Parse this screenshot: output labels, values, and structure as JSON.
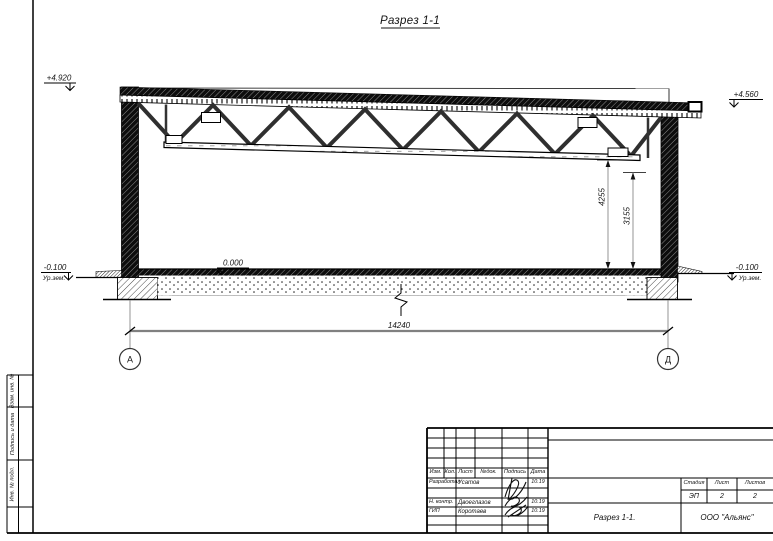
{
  "ink_color": "#141414",
  "dim_line_color": "#808080",
  "drawing": {
    "section_title": "Разрез 1-1",
    "elevation_marks": {
      "roof_left": "+4.920",
      "roof_right": "+4.560",
      "floor": "0.000",
      "ground_left": "-0.100",
      "ground_left_label": "Ур.зем.",
      "ground_right": "-0.100",
      "ground_right_label": "Ур.зем."
    },
    "dimensions": {
      "overall_span": "14240",
      "truss_bottom_height": "4255",
      "clear_height": "3155"
    },
    "axes": {
      "left": "А",
      "right": "Д"
    }
  },
  "titleblock": {
    "header_cols": [
      "Изм.",
      "Кол.",
      "Лист",
      "№док.",
      "Подпись",
      "Дата"
    ],
    "rows": [
      {
        "role": "Разработал",
        "name": "Усатов",
        "date": "10.19"
      },
      {
        "role": "Н. контр.",
        "name": "Двоеглазов",
        "date": "10.19"
      },
      {
        "role": "ГИП",
        "name": "Коротаев",
        "date": "10.19"
      }
    ],
    "stage_header": [
      "Стадия",
      "Лист",
      "Листов"
    ],
    "stage": "ЭП",
    "sheet": "2",
    "sheets_total": "2",
    "doc_name": "Разрез 1-1.",
    "company": "ООО \"Альянс\""
  },
  "side_stamp": {
    "labels": [
      "Взам. инв. №",
      "Подпись и дата",
      "Инв. № подл."
    ]
  }
}
